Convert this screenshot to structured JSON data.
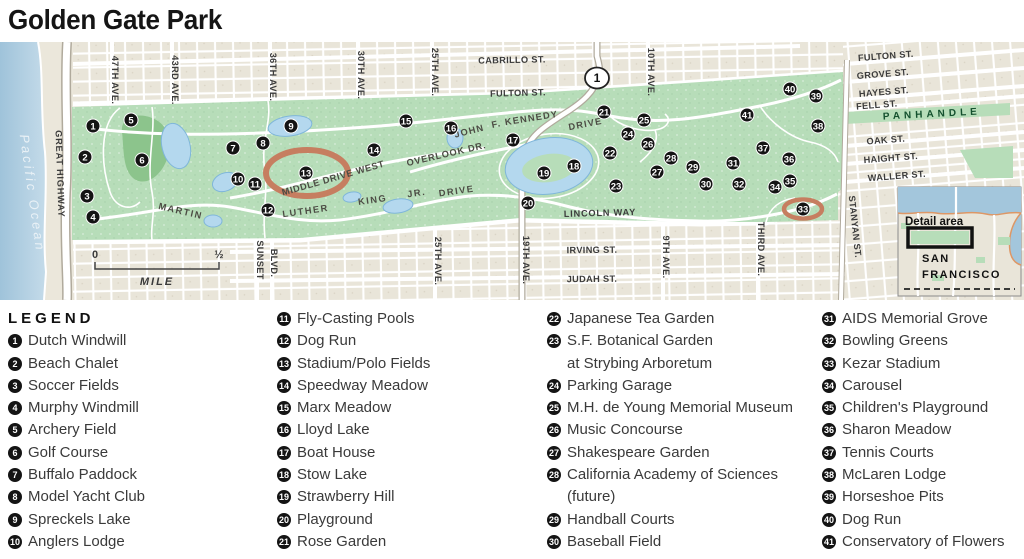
{
  "title": "Golden Gate Park",
  "legend": {
    "header": "LEGEND",
    "columns": [
      {
        "x": 8,
        "items": [
          {
            "n": 1,
            "lines": [
              "Dutch Windwill"
            ]
          },
          {
            "n": 2,
            "lines": [
              "Beach Chalet"
            ]
          },
          {
            "n": 3,
            "lines": [
              "Soccer Fields"
            ]
          },
          {
            "n": 4,
            "lines": [
              "Murphy Windmill"
            ]
          },
          {
            "n": 5,
            "lines": [
              "Archery Field"
            ]
          },
          {
            "n": 6,
            "lines": [
              "Golf Course"
            ]
          },
          {
            "n": 7,
            "lines": [
              "Buffalo Paddock"
            ]
          },
          {
            "n": 8,
            "lines": [
              "Model Yacht Club"
            ]
          },
          {
            "n": 9,
            "lines": [
              "Spreckels Lake"
            ]
          },
          {
            "n": 10,
            "lines": [
              "Anglers Lodge"
            ]
          }
        ]
      },
      {
        "x": 277,
        "items": [
          {
            "n": 11,
            "lines": [
              "Fly-Casting Pools"
            ]
          },
          {
            "n": 12,
            "lines": [
              "Dog Run"
            ]
          },
          {
            "n": 13,
            "lines": [
              "Stadium/Polo Fields"
            ]
          },
          {
            "n": 14,
            "lines": [
              "Speedway Meadow"
            ]
          },
          {
            "n": 15,
            "lines": [
              "Marx Meadow"
            ]
          },
          {
            "n": 16,
            "lines": [
              "Lloyd Lake"
            ]
          },
          {
            "n": 17,
            "lines": [
              "Boat House"
            ]
          },
          {
            "n": 18,
            "lines": [
              "Stow Lake"
            ]
          },
          {
            "n": 19,
            "lines": [
              "Strawberry Hill"
            ]
          },
          {
            "n": 20,
            "lines": [
              "Playground"
            ]
          },
          {
            "n": 21,
            "lines": [
              "Rose Garden"
            ]
          }
        ]
      },
      {
        "x": 547,
        "items": [
          {
            "n": 22,
            "lines": [
              "Japanese Tea Garden"
            ]
          },
          {
            "n": 23,
            "lines": [
              "S.F. Botanical Garden",
              "at Strybing Arboretum"
            ]
          },
          {
            "n": 24,
            "lines": [
              "Parking Garage"
            ]
          },
          {
            "n": 25,
            "lines": [
              "M.H. de Young Memorial Museum"
            ]
          },
          {
            "n": 26,
            "lines": [
              "Music Concourse"
            ]
          },
          {
            "n": 27,
            "lines": [
              "Shakespeare Garden"
            ]
          },
          {
            "n": 28,
            "lines": [
              "California Academy of Sciences",
              "(future)"
            ]
          },
          {
            "n": 29,
            "lines": [
              "Handball Courts"
            ]
          },
          {
            "n": 30,
            "lines": [
              "Baseball Field"
            ]
          }
        ]
      },
      {
        "x": 822,
        "items": [
          {
            "n": 31,
            "lines": [
              "AIDS Memorial Grove"
            ]
          },
          {
            "n": 32,
            "lines": [
              "Bowling Greens"
            ]
          },
          {
            "n": 33,
            "lines": [
              "Kezar Stadium"
            ]
          },
          {
            "n": 34,
            "lines": [
              "Carousel"
            ]
          },
          {
            "n": 35,
            "lines": [
              "Children's Playground"
            ]
          },
          {
            "n": 36,
            "lines": [
              "Sharon Meadow"
            ]
          },
          {
            "n": 37,
            "lines": [
              "Tennis Courts"
            ]
          },
          {
            "n": 38,
            "lines": [
              "McLaren Lodge"
            ]
          },
          {
            "n": 39,
            "lines": [
              "Horseshoe Pits"
            ]
          },
          {
            "n": 40,
            "lines": [
              "Dog Run"
            ]
          },
          {
            "n": 41,
            "lines": [
              "Conservatory of Flowers"
            ]
          }
        ]
      }
    ]
  },
  "map": {
    "colors": {
      "park": "#b7ddb9",
      "city": "#e9e5d9",
      "ocean": "#a3c6dc",
      "sand": "#ebe7db",
      "water": "#b4d8ee",
      "stadium": "#c67e60",
      "panhandle_text": "#14512e",
      "label": "#3b3b3b"
    },
    "shield": "1",
    "scale": {
      "zero": "0",
      "half": "½",
      "unit": "MILE"
    },
    "inset": {
      "detail_label": "Detail area",
      "city_line1": "SAN",
      "city_line2": "FRANCISCO"
    },
    "labels": [
      {
        "t": "CABRILLO ST.",
        "x": 512,
        "y": 21,
        "r": -1
      },
      {
        "t": "FULTON ST.",
        "x": 518,
        "y": 54,
        "r": -1.5
      },
      {
        "t": "47TH AVE.",
        "x": 112,
        "y": 38,
        "r": 90
      },
      {
        "t": "43RD AVE.",
        "x": 172,
        "y": 38,
        "r": 90
      },
      {
        "t": "36TH AVE.",
        "x": 270,
        "y": 35,
        "r": 90
      },
      {
        "t": "30TH AVE.",
        "x": 358,
        "y": 33,
        "r": 90
      },
      {
        "t": "25TH AVE.",
        "x": 432,
        "y": 30,
        "r": 90
      },
      {
        "t": "10TH AVE.",
        "x": 648,
        "y": 30,
        "r": 90
      },
      {
        "t": "FULTON ST.",
        "x": 886,
        "y": 17,
        "r": -4.5
      },
      {
        "t": "GROVE ST.",
        "x": 883,
        "y": 35,
        "r": -4.5
      },
      {
        "t": "HAYES ST.",
        "x": 884,
        "y": 53,
        "r": -4.5
      },
      {
        "t": "FELL ST.",
        "x": 877,
        "y": 66,
        "r": -4.5
      },
      {
        "t": "OAK ST.",
        "x": 886,
        "y": 101,
        "r": -4.5
      },
      {
        "t": "HAIGHT ST.",
        "x": 891,
        "y": 119,
        "r": -4.5
      },
      {
        "t": "WALLER ST.",
        "x": 897,
        "y": 137,
        "r": -4.5
      },
      {
        "t": "PANHANDLE",
        "x": 932,
        "y": 75,
        "r": -3,
        "s": 10,
        "ls": 4,
        "fill": "#14512e"
      },
      {
        "t": "LINCOLN WAY",
        "x": 600,
        "y": 174,
        "r": -1.5,
        "ls": 0.8
      },
      {
        "t": "IRVING ST.",
        "x": 592,
        "y": 211,
        "r": -0.5
      },
      {
        "t": "JUDAH ST.",
        "x": 592,
        "y": 240,
        "r": -0.5
      },
      {
        "t": "25TH AVE.",
        "x": 435,
        "y": 219,
        "r": 90
      },
      {
        "t": "19TH AVE.",
        "x": 523,
        "y": 218,
        "r": 90
      },
      {
        "t": "SUNSET",
        "x": 257,
        "y": 218,
        "r": 90
      },
      {
        "t": "BLVD.",
        "x": 271,
        "y": 221,
        "r": 90
      },
      {
        "t": "9TH AVE.",
        "x": 663,
        "y": 215,
        "r": 90
      },
      {
        "t": "THIRD AVE.",
        "x": 758,
        "y": 207,
        "r": 90
      },
      {
        "t": "STANYAN ST.",
        "x": 852,
        "y": 185,
        "r": 84
      },
      {
        "t": "GREAT HIGHWAY",
        "x": 57,
        "y": 132,
        "r": 88,
        "ls": 0.8
      },
      {
        "t": "JOHN",
        "x": 470,
        "y": 92,
        "r": -14,
        "fill": "#4c4c44",
        "ls": 1.2,
        "s": 9.3
      },
      {
        "t": "F.",
        "x": 497,
        "y": 85,
        "r": -12,
        "fill": "#4c4c44",
        "ls": 1.2,
        "s": 9.3
      },
      {
        "t": "KENNEDY",
        "x": 532,
        "y": 79,
        "r": -9,
        "fill": "#4c4c44",
        "ls": 1.2,
        "s": 9.3
      },
      {
        "t": "DRIVE",
        "x": 586,
        "y": 85,
        "r": -11,
        "fill": "#4c4c44",
        "ls": 1.2,
        "s": 9.3
      },
      {
        "t": "OVERLOOK DR.",
        "x": 447,
        "y": 115,
        "r": -13,
        "fill": "#4c4c44",
        "ls": 0.8,
        "s": 9.3
      },
      {
        "t": "MIDDLE DRIVE WEST",
        "x": 334,
        "y": 139,
        "r": -16,
        "fill": "#4c4c44",
        "ls": 0.6,
        "s": 9.3
      },
      {
        "t": "MARTIN",
        "x": 180,
        "y": 172,
        "r": 13,
        "fill": "#4c4c44",
        "ls": 1.5,
        "s": 9.3
      },
      {
        "t": "LUTHER",
        "x": 306,
        "y": 172,
        "r": -8,
        "fill": "#4c4c44",
        "ls": 1.5,
        "s": 9.3
      },
      {
        "t": "KING",
        "x": 373,
        "y": 161,
        "r": -8,
        "fill": "#4c4c44",
        "ls": 1.5,
        "s": 9.3
      },
      {
        "t": "JR.",
        "x": 417,
        "y": 154,
        "r": -8,
        "fill": "#4c4c44",
        "ls": 1.5,
        "s": 9.3
      },
      {
        "t": "DRIVE",
        "x": 457,
        "y": 152,
        "r": -8,
        "fill": "#4c4c44",
        "ls": 1.5,
        "s": 9.3
      },
      {
        "t": "Pacific Ocean",
        "x": 28,
        "y": 152,
        "r": 82,
        "s": 13,
        "it": true,
        "fill": "#e9f1f6",
        "ls": 3,
        "w": 400
      }
    ],
    "markers": [
      {
        "n": 1,
        "x": 93,
        "y": 84
      },
      {
        "n": 2,
        "x": 85,
        "y": 115
      },
      {
        "n": 3,
        "x": 87,
        "y": 154
      },
      {
        "n": 4,
        "x": 93,
        "y": 175
      },
      {
        "n": 5,
        "x": 131,
        "y": 78
      },
      {
        "n": 6,
        "x": 142,
        "y": 118
      },
      {
        "n": 7,
        "x": 233,
        "y": 106
      },
      {
        "n": 8,
        "x": 263,
        "y": 101
      },
      {
        "n": 9,
        "x": 291,
        "y": 84
      },
      {
        "n": 10,
        "x": 238,
        "y": 137
      },
      {
        "n": 11,
        "x": 255,
        "y": 142
      },
      {
        "n": 12,
        "x": 268,
        "y": 168
      },
      {
        "n": 13,
        "x": 306,
        "y": 131
      },
      {
        "n": 14,
        "x": 374,
        "y": 108
      },
      {
        "n": 15,
        "x": 406,
        "y": 79
      },
      {
        "n": 16,
        "x": 451,
        "y": 86
      },
      {
        "n": 17,
        "x": 513,
        "y": 98
      },
      {
        "n": 18,
        "x": 574,
        "y": 124
      },
      {
        "n": 19,
        "x": 544,
        "y": 131
      },
      {
        "n": 20,
        "x": 528,
        "y": 161
      },
      {
        "n": 21,
        "x": 604,
        "y": 70
      },
      {
        "n": 22,
        "x": 610,
        "y": 111
      },
      {
        "n": 23,
        "x": 616,
        "y": 144
      },
      {
        "n": 24,
        "x": 628,
        "y": 92
      },
      {
        "n": 25,
        "x": 644,
        "y": 78
      },
      {
        "n": 26,
        "x": 648,
        "y": 102
      },
      {
        "n": 27,
        "x": 657,
        "y": 130
      },
      {
        "n": 28,
        "x": 671,
        "y": 116
      },
      {
        "n": 29,
        "x": 693,
        "y": 125
      },
      {
        "n": 30,
        "x": 706,
        "y": 142
      },
      {
        "n": 31,
        "x": 733,
        "y": 121
      },
      {
        "n": 32,
        "x": 739,
        "y": 142
      },
      {
        "n": 33,
        "x": 803,
        "y": 167
      },
      {
        "n": 34,
        "x": 775,
        "y": 145
      },
      {
        "n": 35,
        "x": 790,
        "y": 139
      },
      {
        "n": 36,
        "x": 789,
        "y": 117
      },
      {
        "n": 37,
        "x": 763,
        "y": 106
      },
      {
        "n": 38,
        "x": 818,
        "y": 84
      },
      {
        "n": 39,
        "x": 816,
        "y": 54
      },
      {
        "n": 40,
        "x": 790,
        "y": 47
      },
      {
        "n": 41,
        "x": 747,
        "y": 73
      }
    ]
  }
}
